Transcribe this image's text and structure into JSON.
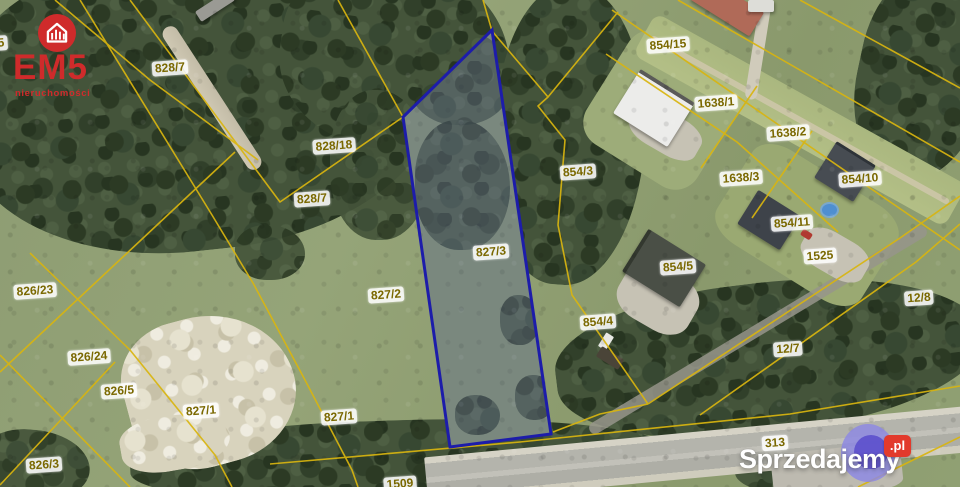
{
  "branding": {
    "name": "EM5",
    "tagline": "nieruchomości",
    "brand_color": "#cf2b2b"
  },
  "watermark": {
    "name": "Sprzedajemy",
    "suffix": ".pl",
    "badge_color": "#e23a2c",
    "circle_outer_color": "#8c87e4",
    "circle_inner_color": "#5c50cc"
  },
  "map": {
    "kind": "cadastral-aerial-photo",
    "highlighted_parcel": "827/3",
    "boundary_line_color": "#d9b50f",
    "highlight_outline_color": "#1d1caa",
    "parcel_labels": [
      {
        "t": "5",
        "x": 1,
        "y": 43
      },
      {
        "t": "828/7",
        "x": 170,
        "y": 68
      },
      {
        "t": "854/15",
        "x": 668,
        "y": 45
      },
      {
        "t": "1638/1",
        "x": 716,
        "y": 103
      },
      {
        "t": "1638/2",
        "x": 788,
        "y": 133
      },
      {
        "t": "828/18",
        "x": 334,
        "y": 146
      },
      {
        "t": "854/3",
        "x": 578,
        "y": 172
      },
      {
        "t": "1638/3",
        "x": 741,
        "y": 178
      },
      {
        "t": "854/10",
        "x": 860,
        "y": 179
      },
      {
        "t": "828/7",
        "x": 312,
        "y": 199
      },
      {
        "t": "854/11",
        "x": 792,
        "y": 223
      },
      {
        "t": "827/3",
        "x": 491,
        "y": 252
      },
      {
        "t": "1525",
        "x": 820,
        "y": 256
      },
      {
        "t": "854/5",
        "x": 678,
        "y": 267
      },
      {
        "t": "826/23",
        "x": 35,
        "y": 291
      },
      {
        "t": "827/2",
        "x": 386,
        "y": 295
      },
      {
        "t": "12/8",
        "x": 919,
        "y": 298
      },
      {
        "t": "854/4",
        "x": 598,
        "y": 322
      },
      {
        "t": "12/7",
        "x": 788,
        "y": 349
      },
      {
        "t": "826/24",
        "x": 89,
        "y": 357
      },
      {
        "t": "826/5",
        "x": 119,
        "y": 391
      },
      {
        "t": "827/1",
        "x": 201,
        "y": 411
      },
      {
        "t": "827/1",
        "x": 339,
        "y": 417
      },
      {
        "t": "313",
        "x": 775,
        "y": 443
      },
      {
        "t": "826/3",
        "x": 44,
        "y": 465
      },
      {
        "t": "1509",
        "x": 400,
        "y": 484
      }
    ]
  }
}
